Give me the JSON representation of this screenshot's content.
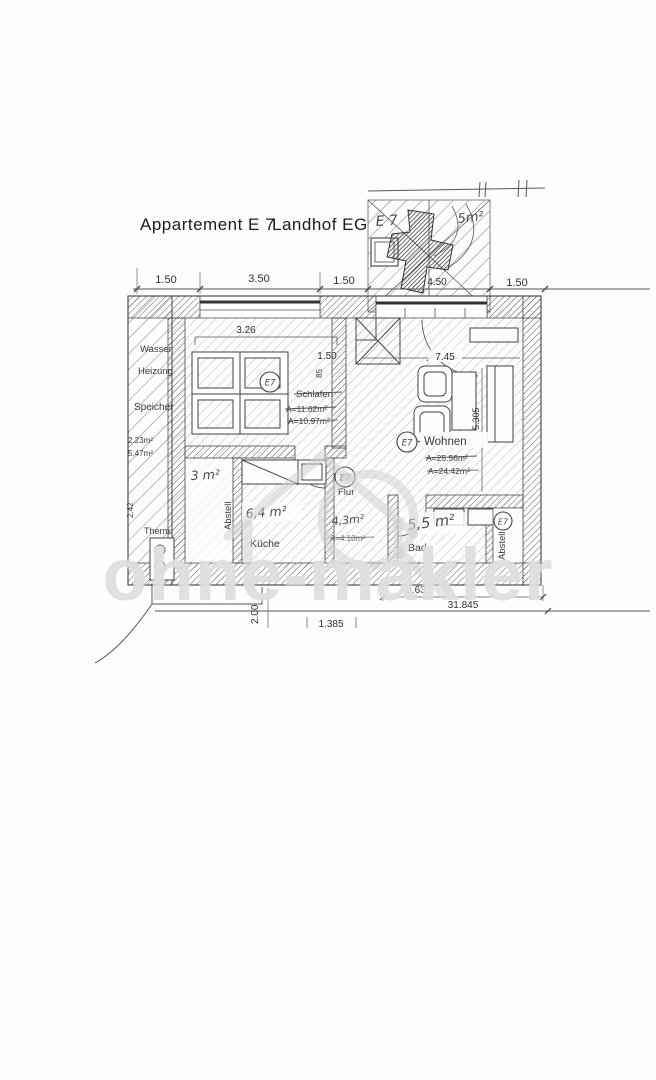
{
  "title": {
    "part1": "Appartement E 7",
    "part2": "Landhof EG"
  },
  "watermark": "ohne-makler",
  "unit_badge": "E7",
  "terrace": {
    "hand_id": "E 7",
    "hand_area": "5m²",
    "dim": "4.50",
    "hand_label": "Terrasse"
  },
  "top_dims": {
    "d1": "1.50",
    "d2": "3.50",
    "d3": "1.50",
    "d4": "1.50"
  },
  "left_zone": {
    "wasser": "Wasser",
    "heizung": "Heizung",
    "speicher": "Speicher",
    "area_small": "2.23m²",
    "area_large": "5.47m²",
    "therm": "Therm.",
    "dim": "2.42"
  },
  "schlafen": {
    "name": "Schlafen",
    "dim_width": "3.26",
    "dim_door": "1.50",
    "area_old": "A=11.62m²",
    "area_new": "A=10.97m²",
    "door_mark": "85"
  },
  "wohnen": {
    "name": "Wohnen",
    "dim_width": "7.45",
    "dim_height": "5.305",
    "area_old": "A=25.56m²",
    "area_new": "A=24.42m²"
  },
  "flur": {
    "name": "Flur",
    "hand_area": "4,3m²",
    "area_old": "A=4.10m²"
  },
  "kueche": {
    "name": "Küche",
    "hand_area": "6,4 m²"
  },
  "bad": {
    "name": "Bad",
    "hand_area": "5,5 m²"
  },
  "abstell_left": {
    "name": "Abstell",
    "hand_area": "3 m²"
  },
  "abstell_right": {
    "name": "Abstell"
  },
  "bottom_dims": {
    "d363": "3.63",
    "total": "31.845",
    "d200": "2.00",
    "d1385": "1.385"
  }
}
